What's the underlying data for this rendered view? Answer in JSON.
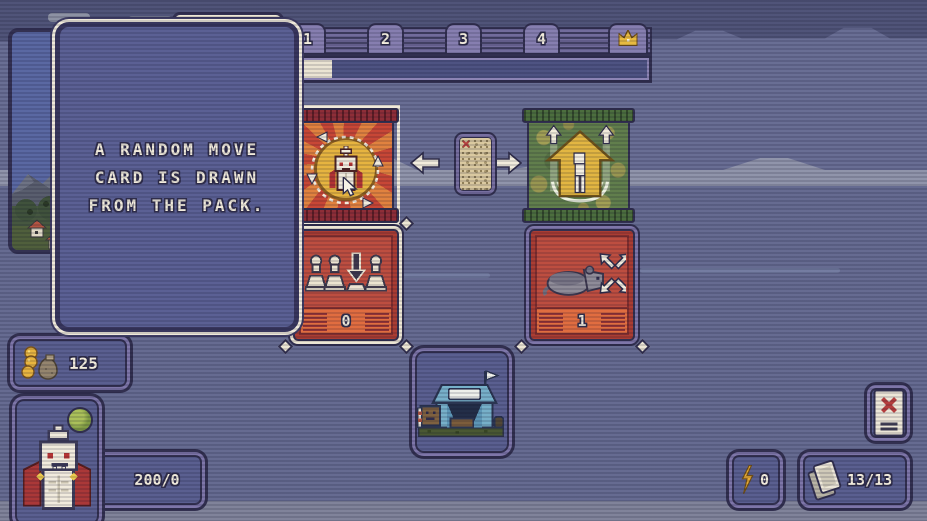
{
  "tooltip": {
    "lines": [
      "A RANDOM MOVE",
      "CARD IS DRAWN",
      "FROM THE PACK."
    ]
  },
  "top_bar": {
    "tabs": [
      {
        "label": "1"
      },
      {
        "label": "2"
      },
      {
        "label": "3"
      },
      {
        "label": "4"
      }
    ],
    "progress_percent": 12
  },
  "cards": [
    {
      "count": "0"
    },
    {
      "count": "1"
    }
  ],
  "hud": {
    "coins": "125",
    "health": "200/0",
    "energy": "0",
    "deck": "13/13"
  },
  "icons": {
    "crown": "crown-icon",
    "coins": "coins-bag-icon",
    "energy": "lightning-icon",
    "deck": "card-stack-icon",
    "discard": "discard-card-icon",
    "arrow_left": "arrow-left-icon",
    "arrow_right": "arrow-right-icon",
    "camp": "tent-icon",
    "character": "vampire-icon",
    "orb": "green-orb-icon"
  },
  "colors": {
    "background": "#666b92",
    "panel": "#575c8e",
    "panel_border": "#7b73a7",
    "outline": "#2e2c4c",
    "cream": "#ece5d3",
    "card_red": "#bc4a3c",
    "banner_orange": "#e06a3c",
    "pack_green": "#5e7b49",
    "gold": "#e5b23c"
  }
}
